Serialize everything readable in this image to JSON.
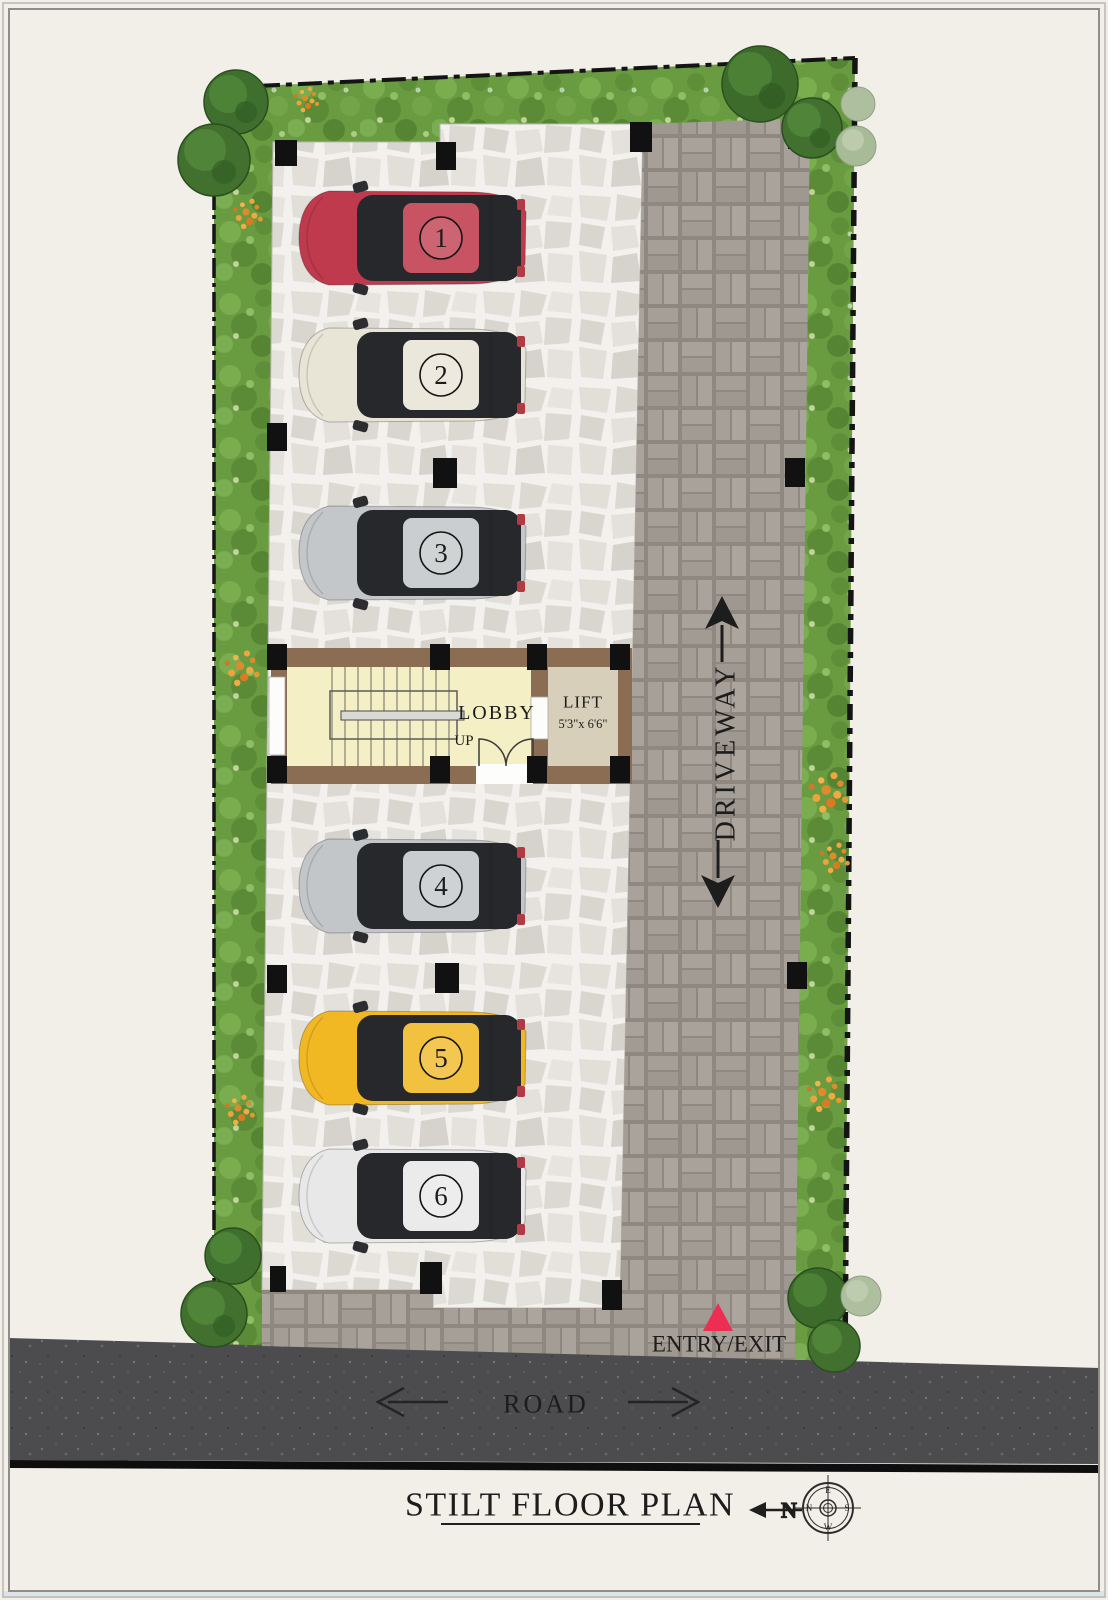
{
  "plan_title": "STILT FLOOR PLAN",
  "labels": {
    "road": "ROAD",
    "driveway": "DRIVEWAY",
    "entry_exit": "ENTRY/EXIT",
    "lobby": "LOBBY",
    "stairs_up": "UP",
    "lift": "LIFT",
    "lift_size": "5'3\"x 6'6\"",
    "north": "N"
  },
  "compass": {
    "top": "E",
    "right": "S",
    "bottom": "W",
    "left": "N"
  },
  "parking_spots": [
    {
      "number": "1",
      "color": "#bf3a4c"
    },
    {
      "number": "2",
      "color": "#e8e4d6"
    },
    {
      "number": "3",
      "color": "#c4c7ca"
    },
    {
      "number": "4",
      "color": "#c2c6c9"
    },
    {
      "number": "5",
      "color": "#f2b824"
    },
    {
      "number": "6",
      "color": "#e7e8e7"
    }
  ],
  "colors": {
    "entry_marker": "#ee2d53",
    "lobby_floor": "#f4efc5",
    "lift_floor": "#d8cfba",
    "wall": "#8a6d52"
  }
}
